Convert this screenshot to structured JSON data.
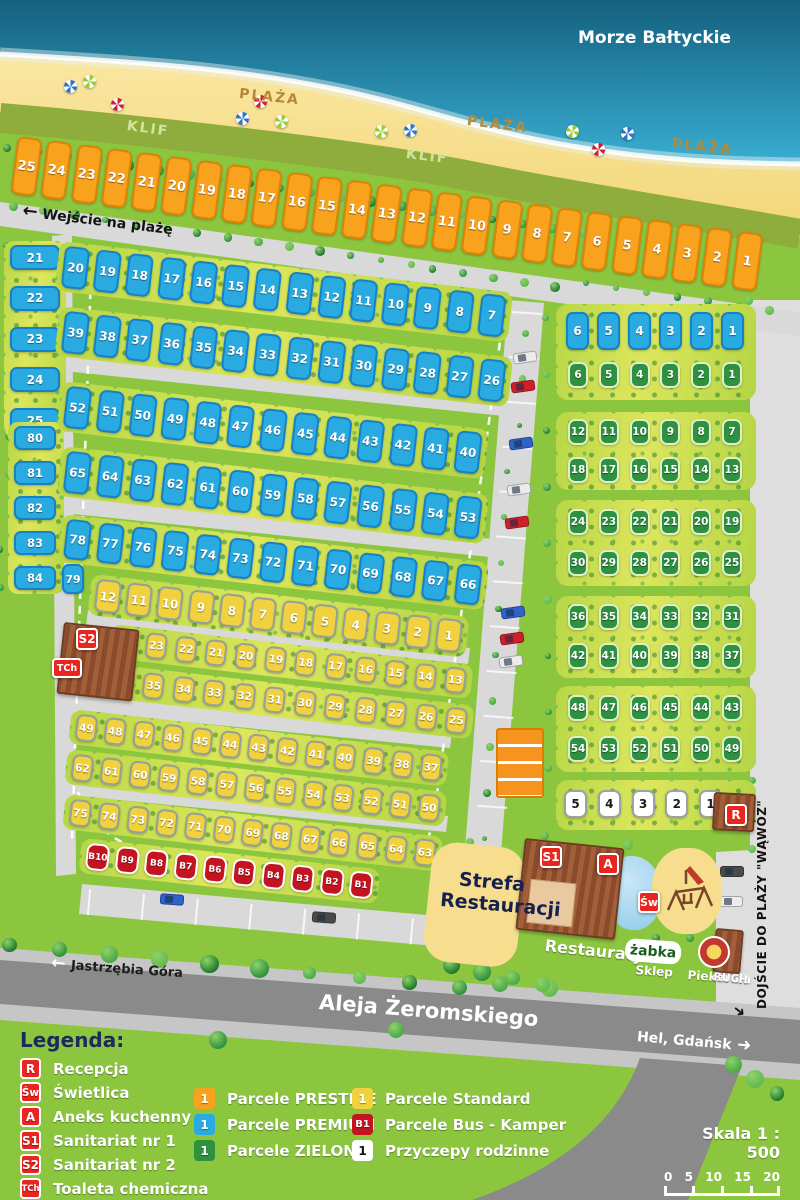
{
  "labels": {
    "sea": "Morze Bałtyckie",
    "plaza": "PLAŻA",
    "klif": "KLIF",
    "beach_entrance": "Wejście na plażę",
    "strefa_line1": "Strefa",
    "strefa_line2": "Restauracji",
    "restauracja": "Restauracja",
    "zabka": "żabka",
    "sklep": "Sklep",
    "piekarnia": "Piekarnia",
    "ruch": "RUCH",
    "dojscie": "DOJŚCIE DO PLAŻY \"WĄWÓZ\"",
    "jastrzebia": "Jastrzębia Góra",
    "aleja": "Aleja Żeromskiego",
    "hel": "Hel, Gdańsk",
    "skala": "Skala 1 : 500",
    "scale_ticks": [
      "0",
      "5",
      "10",
      "15",
      "20"
    ]
  },
  "icons": {
    "arrow_left": "←",
    "arrow_right": "➜",
    "arrow_corridor": "➜"
  },
  "markers": {
    "recepcja": "R",
    "swietlica": "Św",
    "aneks": "A",
    "san1": "S1",
    "san2": "S2",
    "toaleta": "TCh"
  },
  "colors": {
    "prestige": "#F9A21D",
    "premium": "#29ABE2",
    "zielone": "#2E9140",
    "standard": "#F1D23E",
    "bus": "#C41420",
    "family": "#FFFFFF",
    "marker": "#E8251F",
    "sea": "#156A88",
    "sand": "#F6DE8E",
    "grass": "#8CC63F"
  },
  "plot_rows": [
    {
      "id": "prestige",
      "type": "prestige",
      "values": [
        "25",
        "24",
        "23",
        "22",
        "21",
        "20",
        "19",
        "18",
        "17",
        "16",
        "15",
        "14",
        "13",
        "12",
        "11",
        "10",
        "9",
        "8",
        "7",
        "6",
        "5",
        "4",
        "3",
        "2",
        "1"
      ]
    },
    {
      "id": "leftA",
      "type": "premium",
      "values": [
        "21",
        "22",
        "23",
        "24",
        "25"
      ]
    },
    {
      "id": "leftB",
      "type": "premium",
      "values": [
        "80",
        "81",
        "82",
        "83",
        "84"
      ]
    },
    {
      "id": "pA",
      "type": "premium",
      "values": [
        "20",
        "19",
        "18",
        "17",
        "16",
        "15",
        "14",
        "13",
        "12",
        "11",
        "10",
        "9",
        "8",
        "7"
      ]
    },
    {
      "id": "pB",
      "type": "premium",
      "values": [
        "39",
        "38",
        "37",
        "36",
        "35",
        "34",
        "33",
        "32",
        "31",
        "30",
        "29",
        "28",
        "27",
        "26"
      ]
    },
    {
      "id": "pC",
      "type": "premium",
      "values": [
        "52",
        "51",
        "50",
        "49",
        "48",
        "47",
        "46",
        "45",
        "44",
        "43",
        "42",
        "41",
        "40"
      ]
    },
    {
      "id": "pD",
      "type": "premium",
      "values": [
        "65",
        "64",
        "63",
        "62",
        "61",
        "60",
        "59",
        "58",
        "57",
        "56",
        "55",
        "54",
        "53"
      ]
    },
    {
      "id": "pE",
      "type": "premium",
      "values": [
        "78",
        "77",
        "76",
        "75",
        "74",
        "73",
        "72",
        "71",
        "70",
        "69",
        "68",
        "67",
        "66"
      ]
    },
    {
      "id": "p79",
      "type": "premium",
      "values": [
        "79"
      ]
    },
    {
      "id": "sF",
      "type": "standard",
      "values": [
        "12",
        "11",
        "10",
        "9",
        "8",
        "7",
        "6",
        "5",
        "4",
        "3",
        "2",
        "1"
      ]
    },
    {
      "id": "sG",
      "type": "standard",
      "values": [
        "24",
        "23",
        "22",
        "21",
        "20",
        "19",
        "18",
        "17",
        "16",
        "15",
        "14",
        "13"
      ]
    },
    {
      "id": "sH",
      "type": "standard",
      "values": [
        "36",
        "35",
        "34",
        "33",
        "32",
        "31",
        "30",
        "29",
        "28",
        "27",
        "26",
        "25"
      ]
    },
    {
      "id": "sI",
      "type": "standard",
      "values": [
        "49",
        "48",
        "47",
        "46",
        "45",
        "44",
        "43",
        "42",
        "41",
        "40",
        "39",
        "38",
        "37"
      ]
    },
    {
      "id": "sJ",
      "type": "standard",
      "values": [
        "62",
        "61",
        "60",
        "59",
        "58",
        "57",
        "56",
        "55",
        "54",
        "53",
        "52",
        "51",
        "50"
      ]
    },
    {
      "id": "sK",
      "type": "standard",
      "values": [
        "75",
        "74",
        "73",
        "72",
        "71",
        "70",
        "69",
        "68",
        "67",
        "66",
        "65",
        "64",
        "63"
      ]
    },
    {
      "id": "bus",
      "type": "bus",
      "values": [
        "B10",
        "B9",
        "B8",
        "B7",
        "B6",
        "B5",
        "B4",
        "B3",
        "B2",
        "B1"
      ]
    },
    {
      "id": "rBlue",
      "type": "premium",
      "values": [
        "6",
        "5",
        "4",
        "3",
        "2",
        "1"
      ]
    },
    {
      "id": "rg1",
      "type": "zielone",
      "values": [
        "6",
        "5",
        "4",
        "3",
        "2",
        "1"
      ]
    },
    {
      "id": "rg2",
      "type": "zielone",
      "values": [
        "12",
        "11",
        "10",
        "9",
        "8",
        "7"
      ]
    },
    {
      "id": "rg3",
      "type": "zielone",
      "values": [
        "18",
        "17",
        "16",
        "15",
        "14",
        "13"
      ]
    },
    {
      "id": "rg4",
      "type": "zielone",
      "values": [
        "24",
        "23",
        "22",
        "21",
        "20",
        "19"
      ]
    },
    {
      "id": "rg5",
      "type": "zielone",
      "values": [
        "30",
        "29",
        "28",
        "27",
        "26",
        "25"
      ]
    },
    {
      "id": "rg6",
      "type": "zielone",
      "values": [
        "36",
        "35",
        "34",
        "33",
        "32",
        "31"
      ]
    },
    {
      "id": "rg7",
      "type": "zielone",
      "values": [
        "42",
        "41",
        "40",
        "39",
        "38",
        "37"
      ]
    },
    {
      "id": "rg8",
      "type": "zielone",
      "values": [
        "48",
        "47",
        "46",
        "45",
        "44",
        "43"
      ]
    },
    {
      "id": "rg9",
      "type": "zielone",
      "values": [
        "54",
        "53",
        "52",
        "51",
        "50",
        "49"
      ]
    },
    {
      "id": "fam",
      "type": "family",
      "values": [
        "5",
        "4",
        "3",
        "2",
        "1"
      ]
    }
  ],
  "legend": {
    "title": "Legenda:",
    "facilities": [
      {
        "code": "R",
        "label": "Recepcja"
      },
      {
        "code": "Św",
        "label": "Świetlica"
      },
      {
        "code": "A",
        "label": "Aneks kuchenny"
      },
      {
        "code": "S1",
        "label": "Sanitariat nr 1"
      },
      {
        "code": "S2",
        "label": "Sanitariat nr 2"
      },
      {
        "code": "TCh",
        "label": "Toaleta chemiczna"
      }
    ],
    "plot_types": [
      {
        "code": "1",
        "type": "prestige",
        "label": "Parcele PRESTIGE"
      },
      {
        "code": "1",
        "type": "premium",
        "label": "Parcele PREMIUM"
      },
      {
        "code": "1",
        "type": "zielone",
        "label": "Parcele ZIELONE"
      },
      {
        "code": "1",
        "type": "standard",
        "label": "Parcele Standard"
      },
      {
        "code": "B1",
        "type": "bus",
        "label": "Parcele Bus - Kamper"
      },
      {
        "code": "1",
        "type": "family",
        "label": "Przyczepy rodzinne"
      }
    ]
  }
}
